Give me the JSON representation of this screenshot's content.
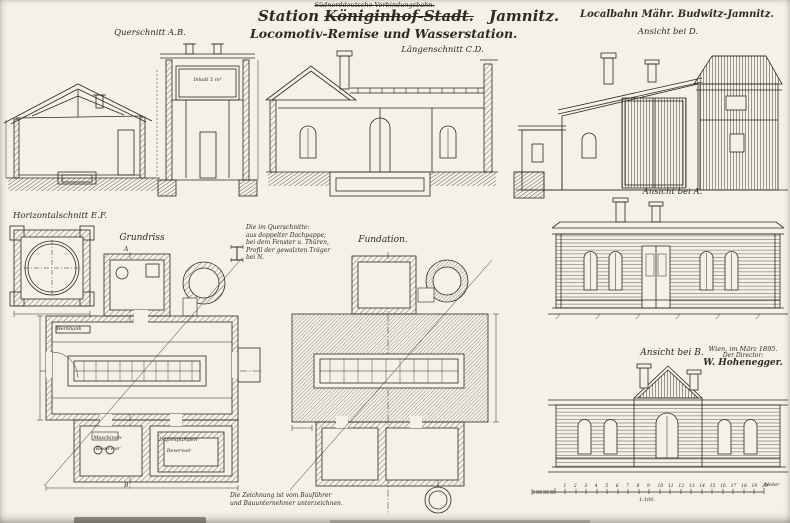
{
  "colors": {
    "paper": "#f3f1e9",
    "ink": "#2c2a25",
    "hatch": "#57544a"
  },
  "header": {
    "struck_railway_line": "Südnorddeutsche Verbindungsbahn.",
    "title_word1": "Station",
    "title_struck": "Königinhof-Stadt.",
    "title_word2": "Jamnitz.",
    "subtitle": "Locomotiv-Remise und Wasserstation.",
    "railway_right": "Localbahn Mähr. Budwitz-Jamnitz."
  },
  "captions": {
    "querschnitt": "Querschnitt A.B.",
    "laengenschnitt": "Längenschnitt C.D.",
    "ansicht_d": "Ansicht bei D.",
    "ansicht_a": "Ansicht bei A.",
    "ansicht_b": "Ansicht bei B.",
    "horizontalschnitt": "Horizontalschnitt E.F.",
    "grundriss": "Grundriss",
    "fundation": "Fundation."
  },
  "section_marks": {
    "top": "A",
    "bottom": "B"
  },
  "drawing_labels": {
    "tank": "Inhalt 5 m³",
    "werkbank": "Werkbank",
    "room_left_line1": "Maschinen-",
    "room_left_line2": "Reservoir",
    "room_mid_line1": "Duplexpumpen-",
    "room_mid_line2": "Reservoir"
  },
  "notes": {
    "spec_lines": [
      "Die im Querschnitte:",
      "aus doppelter Dachpappe;",
      "bei dem Fenster u. Thüren,",
      "Profil der gewalzten Träger",
      "bei N."
    ],
    "bottom_lines": [
      "Die Zeichnung ist vom Bauführer",
      "und Bauunternehmer unterzeichnen."
    ]
  },
  "signature": {
    "place_date": "Wien, im März 1895.",
    "role": "Der Director:",
    "name": "W. Hohenegger."
  },
  "scale_bar": {
    "ratio": "1:100.",
    "unit": "Meter",
    "ticks": [
      "1",
      "2",
      "3",
      "4",
      "5",
      "6",
      "7",
      "8",
      "9",
      "10",
      "11",
      "12",
      "13",
      "14",
      "15",
      "16",
      "17",
      "18",
      "19",
      "20"
    ]
  }
}
